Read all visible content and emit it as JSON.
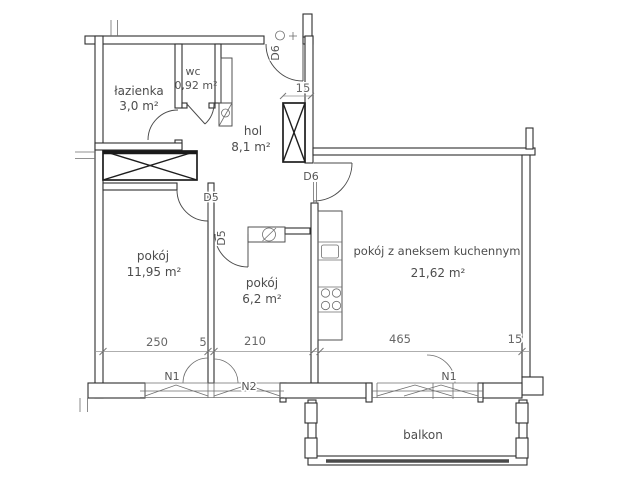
{
  "colors": {
    "wall_line": "#2f2f2f",
    "fixture_line": "#4a4a4a",
    "dimension_line": "#939393",
    "label_text": "#4d4d4d",
    "background": "#ffffff"
  },
  "rooms": [
    {
      "name": "łazienka",
      "area": "3,0 m²"
    },
    {
      "name": "wc",
      "area": "0,92 m²"
    },
    {
      "name": "hol",
      "area": "8,1 m²"
    },
    {
      "name": "pokój",
      "area": "11,95 m²"
    },
    {
      "name": "pokój",
      "area": "6,2 m²"
    },
    {
      "name": "pokój z aneksem kuchennym",
      "area": "21,62 m²"
    },
    {
      "name": "balkon",
      "area": ""
    }
  ],
  "doors": [
    {
      "label": "D5"
    },
    {
      "label": "D5"
    },
    {
      "label": "D6"
    },
    {
      "label": "D6"
    }
  ],
  "windows": [
    {
      "label": "N1"
    },
    {
      "label": "N2"
    },
    {
      "label": "N1"
    }
  ],
  "dimensions": [
    {
      "value": "250"
    },
    {
      "value": "5"
    },
    {
      "value": "210"
    },
    {
      "value": "465"
    },
    {
      "value": "15"
    },
    {
      "value": "15"
    }
  ]
}
